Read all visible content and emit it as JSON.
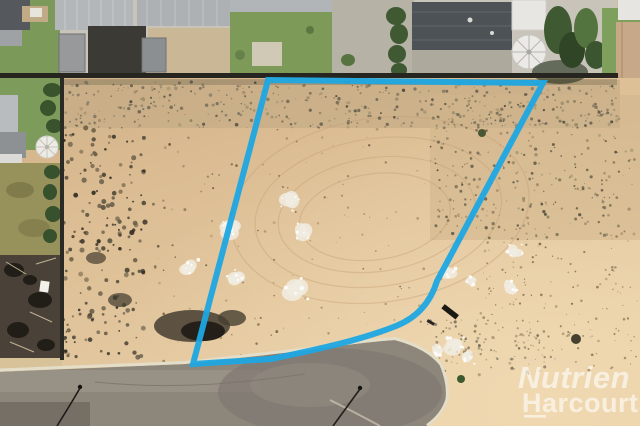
{
  "watermark": {
    "line1": "Nutrien",
    "line2": "Harcourts",
    "color": "#ffffff"
  },
  "boundary": {
    "color": "#1ea7e2",
    "stroke_width": "6",
    "path": "M 268,80 L 543,83 L 437,281 C 430,304 416,318 396,326 C 363,339 329,347 271,359 L 193,364 Z"
  },
  "palette": {
    "sand": "#dcbd93",
    "sand_dark": "#c3ab85",
    "road": "#8d867b",
    "curb": "#e4ddc8",
    "lawn": "#7d9c5c",
    "roof_light": "#b4b7b9",
    "roof_dark": "#4d5256",
    "tree": "#3f5a33",
    "burnt": "#4a4238"
  }
}
